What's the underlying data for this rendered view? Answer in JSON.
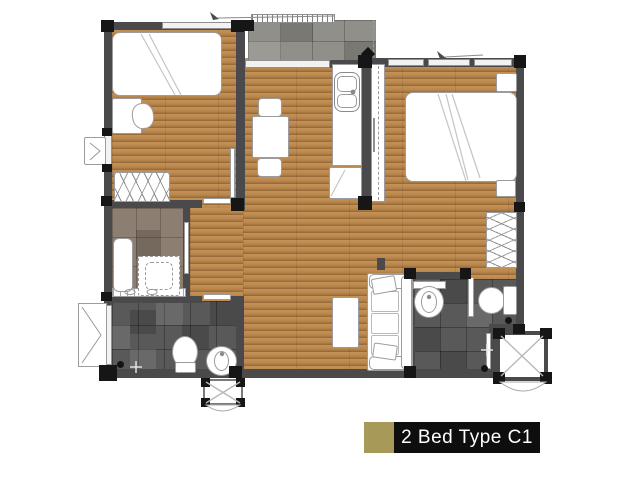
{
  "legend": {
    "label": "2 Bed Type C1",
    "swatch_color": "#a79a58"
  },
  "colors": {
    "canvas_bg": "#ffffff",
    "wall": "#4a4a4c",
    "post": "#161616",
    "wood_light": "#b9874e",
    "wood_dark": "#8f6230",
    "balcony_tile": "#918f8a",
    "bath_tile": "#595959",
    "shower_tile": "#8c7e70",
    "fixture_fill": "#ffffff",
    "fixture_line": "#9c9c9c",
    "accent_gold": "#a79a58",
    "label_bg": "#0e0e0e",
    "label_text": "#ffffff"
  },
  "fixtures": [
    "single-bed",
    "desk",
    "desk-chair",
    "wardrobe",
    "dining-table",
    "dining-chair",
    "kitchen-sink",
    "tall-cabinet",
    "double-bed",
    "nightstand",
    "sofa",
    "coffee-table",
    "shower-tray",
    "water-heater",
    "toilet",
    "wash-basin",
    "vanity-counter",
    "balcony",
    "entry-porch",
    "ac-ledge",
    "casement-window"
  ]
}
